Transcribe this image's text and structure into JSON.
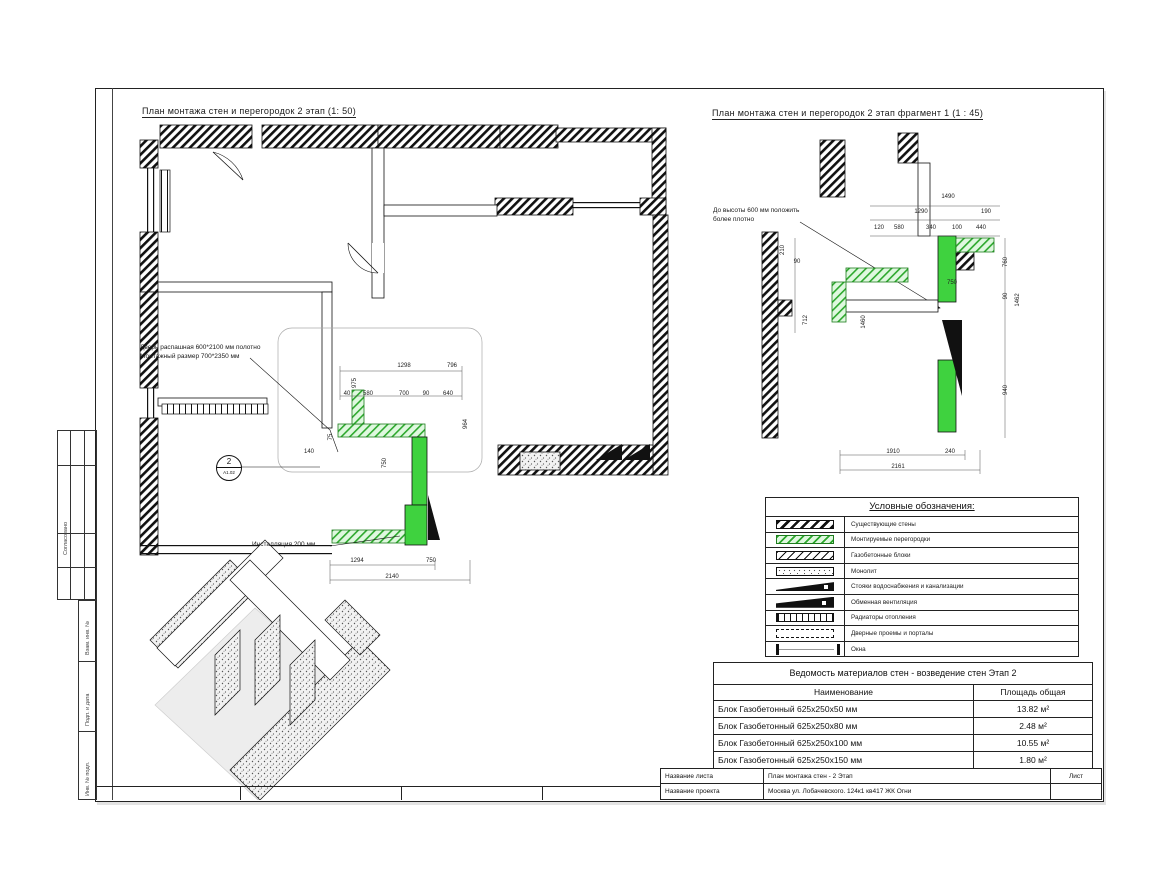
{
  "titles": {
    "plan_title": "План монтажа стен и перегородок   2 этап (1: 50)",
    "fragment_title": "План монтажа стен и перегородок   2 этап   фрагмент 1 (1 : 45)"
  },
  "annotations": {
    "door_note_line1": "Дверь распашная 600*2100 мм полотно",
    "door_note_line2": "Монтажный размер 700*2350 мм",
    "install_note": "Инсталляция 200 мм",
    "fragment_note_line1": "До высоты 600 мм положить",
    "fragment_note_line2": "более плотно",
    "detail_marker": {
      "number": "2",
      "sheet_ref": "А1.02"
    }
  },
  "legend": {
    "title": "Условные обозначения:",
    "items": [
      {
        "swatch": "hatch-black",
        "icon": "existing-wall-hatch-icon",
        "label": "Существующие стены"
      },
      {
        "swatch": "hatch-green",
        "icon": "new-partition-hatch-icon",
        "label": "Монтируемые перегородки"
      },
      {
        "swatch": "hatch-thin",
        "icon": "aerated-block-hatch-icon",
        "label": "Газобетонные блоки"
      },
      {
        "swatch": "stipple",
        "icon": "monolith-stipple-icon",
        "label": "Монолит"
      },
      {
        "swatch": "wedge",
        "icon": "water-sewer-riser-icon",
        "label": "Стояки водоснабжения и канализации"
      },
      {
        "swatch": "wedge-solid",
        "icon": "ventilation-icon",
        "label": "Обменная вентиляция"
      },
      {
        "swatch": "radiator",
        "icon": "radiator-icon",
        "label": "Радиаторы отопления"
      },
      {
        "swatch": "dashed-rect",
        "icon": "door-opening-icon",
        "label": "Дверные проемы и порталы"
      },
      {
        "swatch": "window",
        "icon": "window-icon",
        "label": "Окна"
      }
    ]
  },
  "materials_table": {
    "title": "Ведомость материалов стен - возведение стен Этап 2",
    "columns": [
      "Наименование",
      "Площадь общая"
    ],
    "rows": [
      [
        "Блок Газобетонный 625x250x50 мм",
        "13.82 м²"
      ],
      [
        "Блок Газобетонный 625x250x80 мм",
        "2.48 м²"
      ],
      [
        "Блок Газобетонный 625x250x100 мм",
        "10.55 м²"
      ],
      [
        "Блок Газобетонный 625x250x150 мм",
        "1.80 м²"
      ]
    ]
  },
  "title_block": {
    "sheet_name_label": "Название листа",
    "sheet_name_value": "План монтажа стен - 2 Этап",
    "project_name_label": "Название проекта",
    "project_name_value": "Москва ул. Лобачевского. 124к1 кв417 ЖК Огни",
    "list_label": "Лист"
  },
  "side_stamp": {
    "approved_label": "Согласовано",
    "rows": [
      "Взам. инв. №",
      "Подп. и дата",
      "Инв. № подл."
    ]
  },
  "colors": {
    "new_partition_green": "#3fd23f",
    "partition_hatch_green": "#2da82d",
    "partition_bg_green": "#dff8df",
    "wall_black": "#111111"
  },
  "plan_dimensions": [
    {
      "x": 404,
      "y": 366,
      "t": "1298"
    },
    {
      "x": 452,
      "y": 366,
      "t": "796"
    },
    {
      "x": 355,
      "y": 383,
      "t": "975",
      "rot": 1
    },
    {
      "x": 347,
      "y": 394,
      "t": "40"
    },
    {
      "x": 368,
      "y": 394,
      "t": "580"
    },
    {
      "x": 404,
      "y": 394,
      "t": "700"
    },
    {
      "x": 426,
      "y": 394,
      "t": "90"
    },
    {
      "x": 448,
      "y": 394,
      "t": "640"
    },
    {
      "x": 466,
      "y": 424,
      "t": "964",
      "rot": 1
    },
    {
      "x": 331,
      "y": 437,
      "t": "75",
      "rot": 1
    },
    {
      "x": 309,
      "y": 452,
      "t": "140"
    },
    {
      "x": 385,
      "y": 463,
      "t": "750",
      "rot": 1
    },
    {
      "x": 357,
      "y": 561,
      "t": "1294"
    },
    {
      "x": 431,
      "y": 561,
      "t": "750"
    },
    {
      "x": 392,
      "y": 577,
      "t": "2140"
    }
  ],
  "fragment_dimensions": [
    {
      "x": 948,
      "y": 197,
      "t": "1490"
    },
    {
      "x": 921,
      "y": 212,
      "t": "1290"
    },
    {
      "x": 986,
      "y": 212,
      "t": "190"
    },
    {
      "x": 879,
      "y": 228,
      "t": "120"
    },
    {
      "x": 899,
      "y": 228,
      "t": "580"
    },
    {
      "x": 931,
      "y": 228,
      "t": "340"
    },
    {
      "x": 957,
      "y": 228,
      "t": "100"
    },
    {
      "x": 981,
      "y": 228,
      "t": "440"
    },
    {
      "x": 783,
      "y": 250,
      "t": "210",
      "rot": 1
    },
    {
      "x": 797,
      "y": 262,
      "t": "90"
    },
    {
      "x": 806,
      "y": 320,
      "t": "712",
      "rot": 1
    },
    {
      "x": 864,
      "y": 322,
      "t": "1460",
      "rot": 1
    },
    {
      "x": 1006,
      "y": 262,
      "t": "760",
      "rot": 1
    },
    {
      "x": 1006,
      "y": 296,
      "t": "90",
      "rot": 1
    },
    {
      "x": 1018,
      "y": 300,
      "t": "1462",
      "rot": 1
    },
    {
      "x": 1006,
      "y": 390,
      "t": "940",
      "rot": 1
    },
    {
      "x": 952,
      "y": 283,
      "t": "750"
    },
    {
      "x": 893,
      "y": 452,
      "t": "1910"
    },
    {
      "x": 950,
      "y": 452,
      "t": "240"
    },
    {
      "x": 898,
      "y": 467,
      "t": "2161"
    }
  ]
}
